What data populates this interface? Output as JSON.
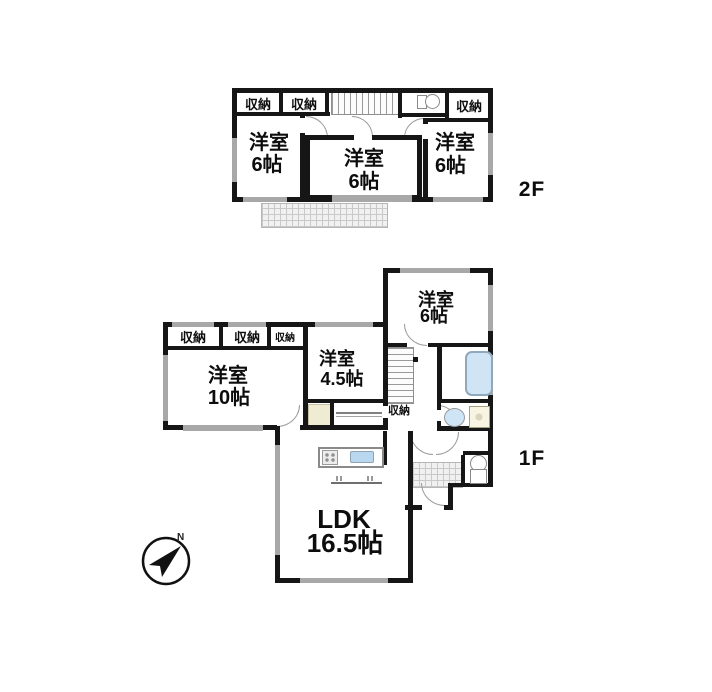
{
  "compass": {
    "north": "N"
  },
  "floor2": {
    "label": "2F",
    "closet_left": "収納",
    "closet_mid": "収納",
    "closet_right": "収納",
    "room_left": {
      "name": "洋室",
      "size": "6帖"
    },
    "room_mid": {
      "name": "洋室",
      "size": "6帖"
    },
    "room_right": {
      "name": "洋室",
      "size": "6帖"
    }
  },
  "floor1": {
    "label": "1F",
    "closet_1": "収納",
    "closet_2": "収納",
    "closet_3": "収納",
    "closet_hall": "収納",
    "room_10": {
      "name": "洋室",
      "size": "10帖"
    },
    "room_45": {
      "name": "洋室",
      "size": "4.5帖"
    },
    "room_6": {
      "name": "洋室",
      "size": "6帖"
    },
    "ldk": {
      "name": "LDK",
      "size": "16.5帖"
    }
  },
  "colors": {
    "wall": "#161616",
    "window": "#a8a8a8",
    "water_fixture": "#cfe4f4",
    "closet_fill": "#f0ebd3"
  }
}
